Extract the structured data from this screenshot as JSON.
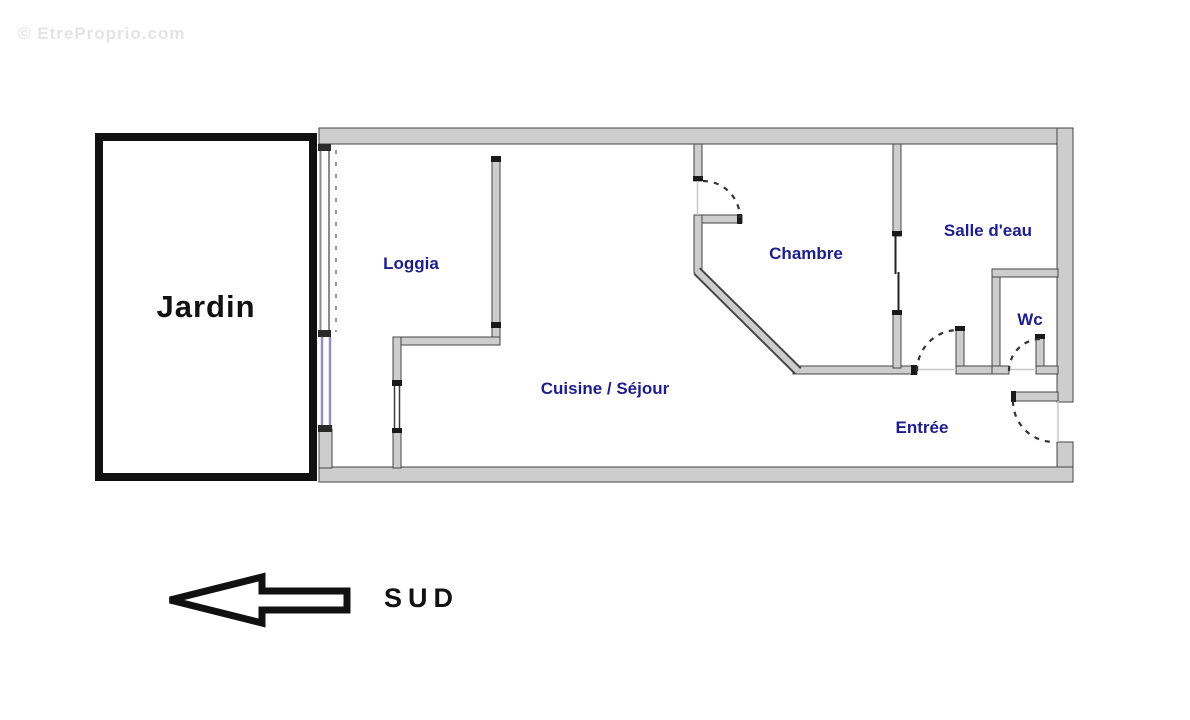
{
  "watermark": "© EtreProprio.com",
  "outdoor": {
    "label": "Jardin"
  },
  "rooms": [
    {
      "id": "loggia",
      "label": "Loggia"
    },
    {
      "id": "cuisine_sejour",
      "label": "Cuisine / Séjour"
    },
    {
      "id": "chambre",
      "label": "Chambre"
    },
    {
      "id": "salle_deau",
      "label": "Salle d'eau"
    },
    {
      "id": "wc",
      "label": "Wc"
    },
    {
      "id": "entree",
      "label": "Entrée"
    }
  ],
  "compass": {
    "label": "SUD",
    "arrow_direction": "left"
  },
  "colors": {
    "wall_fill": "#cdcdcd",
    "wall_outline": "#454545",
    "wall_cap": "#1a1a1a",
    "room_label": "#1e1e8a",
    "jardin_border": "#111111",
    "window": "#9191bb",
    "door_arc": "#333333",
    "watermark": "#e4e4e4"
  }
}
